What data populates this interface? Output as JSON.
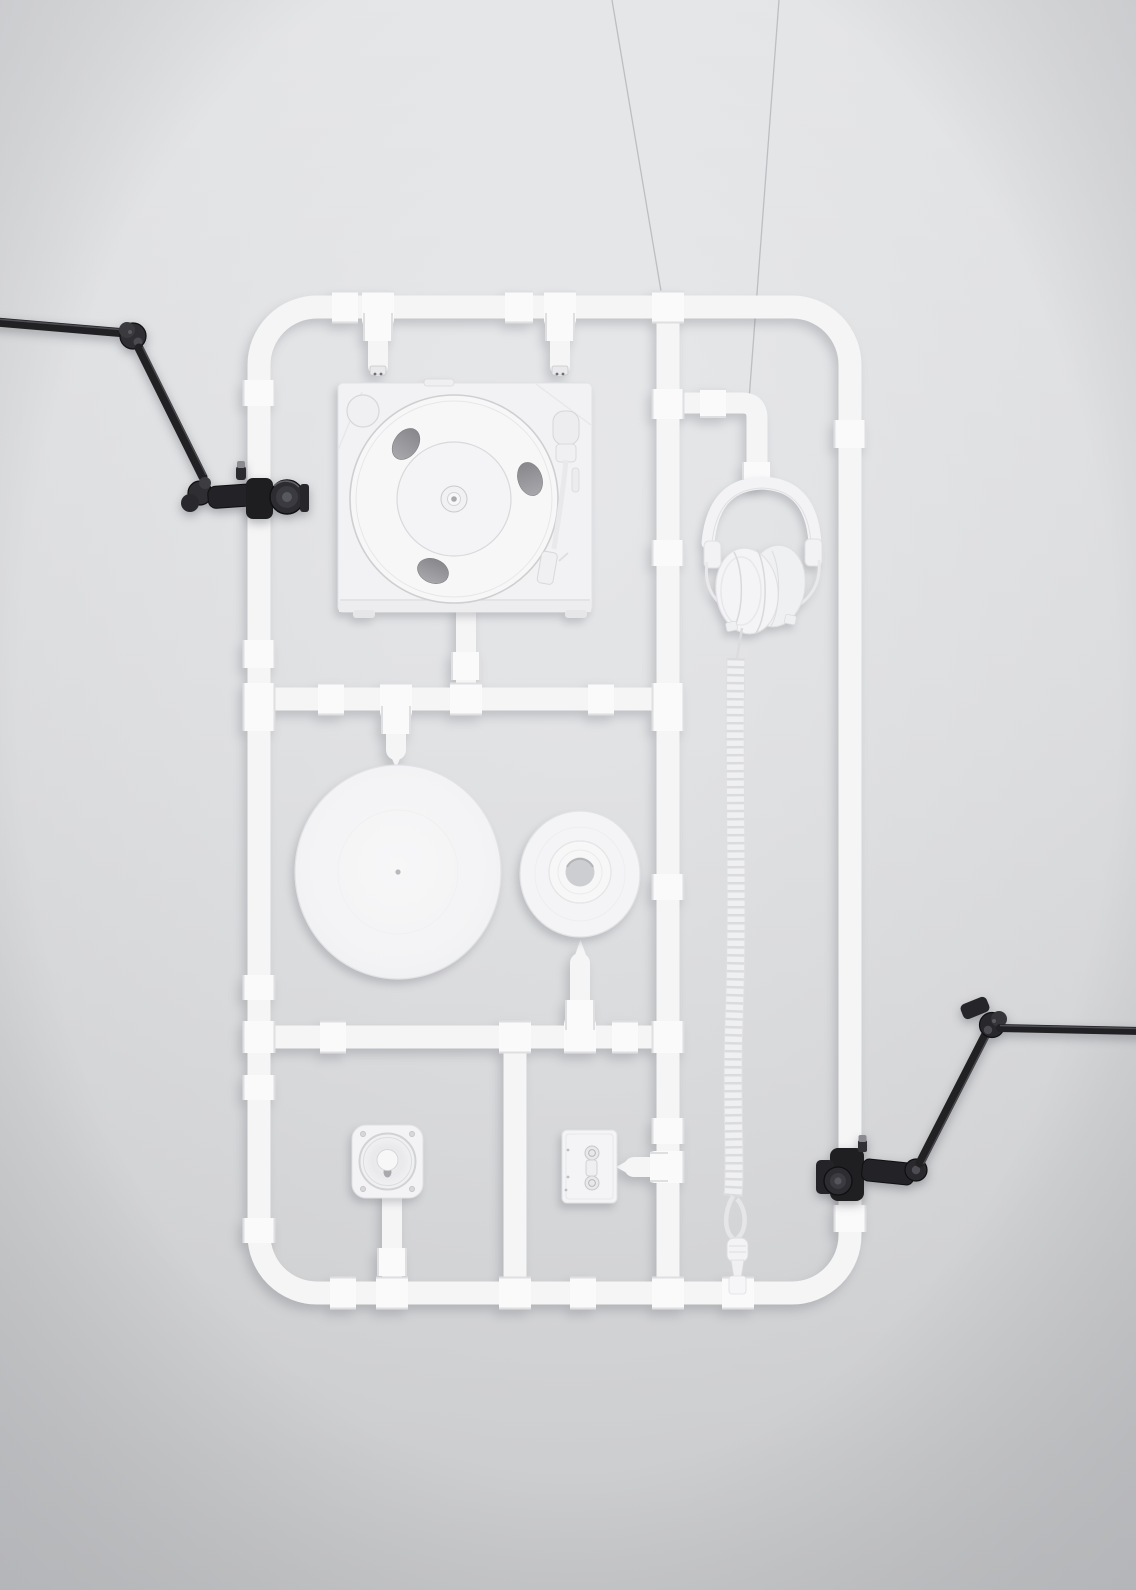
{
  "scene": {
    "label": "White pipe model-kit sculpture: turntable, headphones, vinyl records, speaker and cassette held by black articulated arms",
    "objects": [
      "pipe-frame-sprue",
      "turntable",
      "headphones",
      "vinyl-record-large",
      "vinyl-record-small",
      "speaker-driver",
      "cassette-tape",
      "coiled-headphone-cable",
      "support-arm-left",
      "support-arm-right",
      "suspension-wires"
    ]
  },
  "colors": {
    "bg_top": "#e1e2e4",
    "bg_mid": "#d9dadc",
    "bg_low": "#cbccce",
    "bg_glow": "rgba(240,241,243,0.5)",
    "bg_corner": "rgba(100,103,112,0.22)",
    "pipe": "#f5f5f6",
    "fitting": "#fafafb",
    "seam": "#dfdfe2",
    "panel": "#f2f2f4",
    "panel_bright": "#f7f7f8",
    "line": "#d6d6d9",
    "line_soft": "#e7e7ea",
    "hole_dark": "#88888c",
    "hole_light": "#a8a8ac",
    "recess": "#cdced1",
    "dot": "#aaaaae",
    "arm": "#212124",
    "arm_dark": "#0f0f11",
    "arm_mid": "#2e2e33",
    "arm_light": "#595960",
    "arm_metal": "#8a8b90",
    "wire": "#b4b5b8",
    "shadow": "rgba(70,74,84,0.22)"
  }
}
